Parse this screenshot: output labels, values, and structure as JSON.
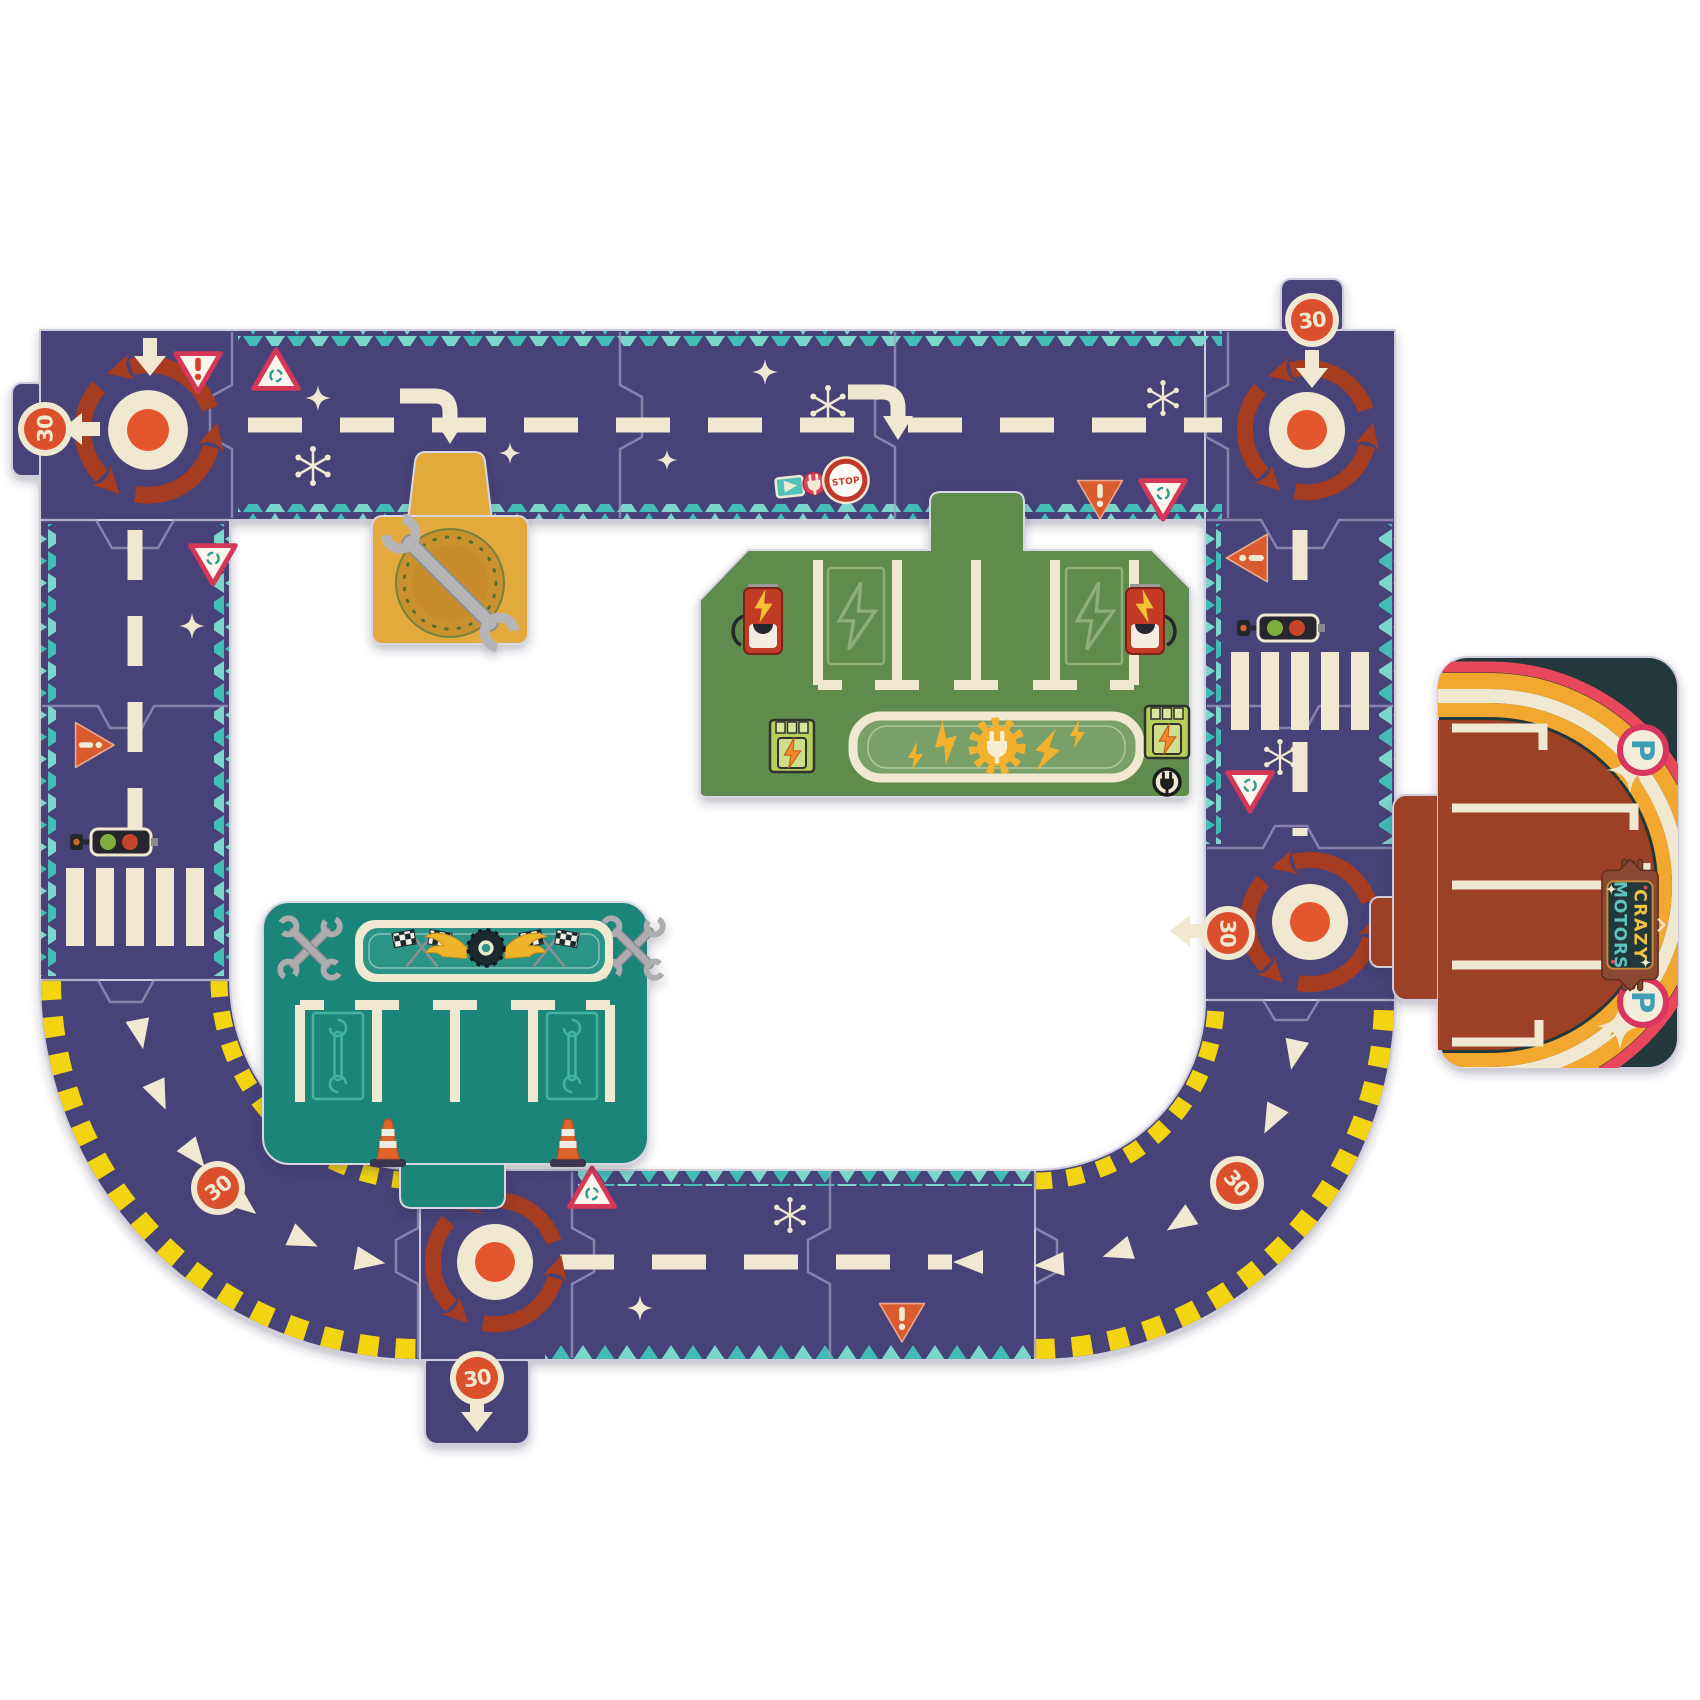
{
  "title": "Crazy Motors giant road puzzle circuit",
  "signs": {
    "speed_limit": "30",
    "stop": "STOP",
    "parking": "P"
  },
  "logo": {
    "line1": "CRAZY",
    "line2": "MOTORS"
  },
  "palette": {
    "road": "#474378",
    "cream": "#f0e8d1",
    "trimA": "#7bd6cc",
    "trimB": "#41bdb5",
    "rust": "#a63c20",
    "flame": "#e3562e",
    "red30": "#dc4f2c",
    "pink": "#d63757",
    "orange": "#d95b2e",
    "hazard": "#f2d410",
    "gold": "#e2a93c",
    "goldDark": "#c9922f",
    "olive": "#5e8b4e",
    "oliveLight": "#7aa06a",
    "teal": "#1b8579",
    "tealLight": "#2a9486",
    "card": "#20383a",
    "brown": "#9c3f26",
    "arcOrange": "#f2a72e",
    "arcRed": "#e8475c",
    "lime": "#b5cf5a",
    "boltOrange": "#f0872a",
    "wing": "#f0b429",
    "badgeBrown": "#8a4a33",
    "pteal": "#3e9fb6"
  },
  "board": {
    "description": "U-shaped jigsaw road circuit with roundabouts, stations and traffic signs",
    "stations": [
      {
        "name": "repair-station",
        "color_key": "gold",
        "icons": [
          "wrench-icon",
          "ring-icon"
        ]
      },
      {
        "name": "charging-station",
        "color_key": "olive",
        "icons": [
          "charging-pump-icon",
          "lightning-bolt-icon",
          "plug-gear-emblem",
          "battery-box-icon",
          "plug-badge-icon",
          "parking-bays"
        ]
      },
      {
        "name": "garage-pit-stop",
        "color_key": "teal",
        "icons": [
          "checkered-flags-icon",
          "winged-tire-icon",
          "crossed-wrenches-icon",
          "wrench-bay-icon",
          "traffic-cone-icon",
          "parking-bays"
        ]
      },
      {
        "name": "crazy-motors-parking",
        "color_key": "card",
        "icons": [
          "parking-badge",
          "rainbow-arcs",
          "crazy-motors-logo",
          "star-icon",
          "parking-bays"
        ]
      }
    ],
    "road_elements": [
      "roundabout-icon",
      "speed-30-sign",
      "stop-sign",
      "yield-sign",
      "roundabout-warning-sign",
      "traffic-light-icon",
      "zebra-crossing",
      "lane-dashes",
      "turn-arrow",
      "chevron-markers",
      "hazard-stripes",
      "sparkle-star",
      "snowflake-mark",
      "electric-charging-sign"
    ]
  }
}
